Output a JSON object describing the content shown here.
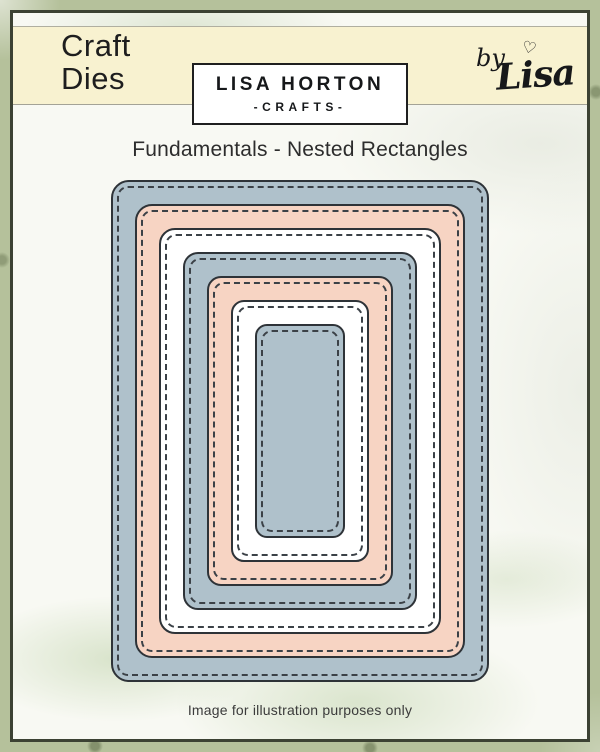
{
  "header": {
    "product_type_line1": "Craft",
    "product_type_line2": "Dies",
    "brand": {
      "name": "LISA HORTON",
      "sub": "-CRAFTS-"
    },
    "signature": {
      "by": "by",
      "name": "Lisa",
      "heart": "♡"
    }
  },
  "title": "Fundamentals - Nested Rectangles",
  "footer": "Image for illustration purposes only",
  "dies": {
    "shape": "nested-stitched-rounded-rectangles",
    "count": 7,
    "layers": [
      {
        "index": 0,
        "name": "rectangle-die-1-largest",
        "color": "#afc1cb"
      },
      {
        "index": 1,
        "name": "rectangle-die-2",
        "color": "#f7d4c3"
      },
      {
        "index": 2,
        "name": "rectangle-die-3",
        "color": "#ffffff"
      },
      {
        "index": 3,
        "name": "rectangle-die-4",
        "color": "#afc1cb"
      },
      {
        "index": 4,
        "name": "rectangle-die-5",
        "color": "#f7d4c3"
      },
      {
        "index": 5,
        "name": "rectangle-die-6",
        "color": "#ffffff"
      },
      {
        "index": 6,
        "name": "rectangle-die-7-smallest",
        "color": "#afc1cb"
      }
    ],
    "outline_color": "#2e3338",
    "stitch_color": "#3b4147"
  },
  "colors": {
    "header_band": "#f8f2d0",
    "page_margin_green": "#b5c19b",
    "frame_border": "#3c4233",
    "content_background": "#f8f9f3"
  }
}
